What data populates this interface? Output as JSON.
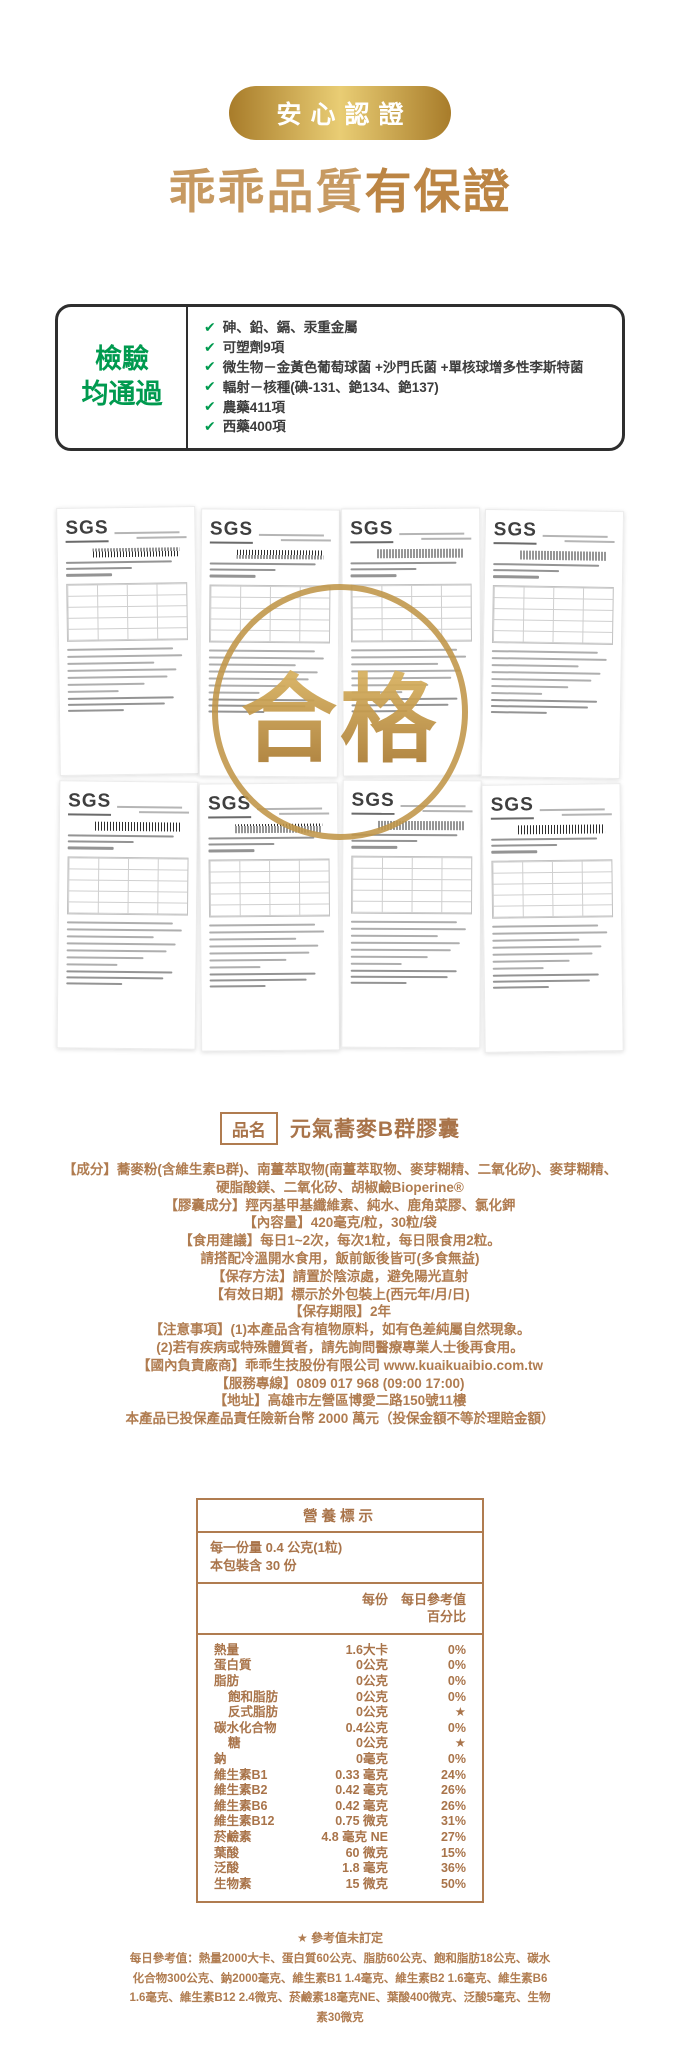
{
  "page": {
    "badge": "安心認證",
    "title_regular": "乖乖品質",
    "title_bold": "有保證",
    "colors": {
      "gold": "#c79a62",
      "green": "#009a4f",
      "tan": "#a9744a"
    }
  },
  "inspection": {
    "label_line1": "檢驗",
    "label_line2": "均通過",
    "check_icon": "✔",
    "items": [
      "砷、鉛、鎘、汞重金屬",
      "可塑劑9項",
      "微生物－金黃色葡萄球菌 +沙門氏菌 +單核球增多性李斯特菌",
      "輻射－核種(碘-131、銫134、銫137)",
      "農藥411項",
      "西藥400項"
    ]
  },
  "certificates": {
    "logo": "SGS",
    "count": 8,
    "stamp_text": "合格"
  },
  "product": {
    "name_label": "品名",
    "name": "元氣蕎麥B群膠囊",
    "details": [
      "【成分】蕎麥粉(含維生素B群)、南薑萃取物(南薑萃取物、麥芽糊精、二氧化矽)、麥芽糊精、",
      "硬脂酸鎂、二氧化矽、胡椒鹼Bioperine®",
      "【膠囊成分】羥丙基甲基纖維素、純水、鹿角菜膠、氯化鉀",
      "【內容量】420毫克/粒，30粒/袋",
      "【食用建議】每日1~2次，每次1粒，每日限食用2粒。",
      "請搭配冷溫開水食用，飯前飯後皆可(多食無益)",
      "【保存方法】請置於陰涼處，避免陽光直射",
      "【有效日期】標示於外包裝上(西元年/月/日)",
      "【保存期限】2年",
      "【注意事項】(1)本產品含有植物原料，如有色差純屬自然現象。",
      "(2)若有疾病或特殊體質者，請先詢問醫療專業人士後再食用。",
      "【國內負責廠商】乖乖生技股份有限公司 www.kuaikuaibio.com.tw",
      "【服務專線】0809 017 968 (09:00 17:00)",
      "【地址】高雄市左營區博愛二路150號11樓",
      "本產品已投保產品責任險新台幣 2000 萬元（投保金額不等於理賠金額）"
    ]
  },
  "nutrition": {
    "title": "營養標示",
    "serving_size": "每一份量 0.4 公克(1粒)",
    "servings_per_pack": "本包裝含 30 份",
    "col_per_serving": "每份",
    "col_daily_value_line1": "每日參考值",
    "col_daily_value_line2": "百分比",
    "rows": [
      {
        "name": "熱量",
        "amount": "1.6大卡",
        "dv": "0%",
        "indent": false
      },
      {
        "name": "蛋白質",
        "amount": "0公克",
        "dv": "0%",
        "indent": false
      },
      {
        "name": "脂肪",
        "amount": "0公克",
        "dv": "0%",
        "indent": false
      },
      {
        "name": "飽和脂肪",
        "amount": "0公克",
        "dv": "0%",
        "indent": true
      },
      {
        "name": "反式脂肪",
        "amount": "0公克",
        "dv": "★",
        "indent": true
      },
      {
        "name": "碳水化合物",
        "amount": "0.4公克",
        "dv": "0%",
        "indent": false
      },
      {
        "name": "糖",
        "amount": "0公克",
        "dv": "★",
        "indent": true
      },
      {
        "name": "鈉",
        "amount": "0毫克",
        "dv": "0%",
        "indent": false
      },
      {
        "name": "維生素B1",
        "amount": "0.33 毫克",
        "dv": "24%",
        "indent": false
      },
      {
        "name": "維生素B2",
        "amount": "0.42 毫克",
        "dv": "26%",
        "indent": false
      },
      {
        "name": "維生素B6",
        "amount": "0.42 毫克",
        "dv": "26%",
        "indent": false
      },
      {
        "name": "維生素B12",
        "amount": "0.75 微克",
        "dv": "31%",
        "indent": false
      },
      {
        "name": "菸鹼素",
        "amount": "4.8 毫克 NE",
        "dv": "27%",
        "indent": false
      },
      {
        "name": "葉酸",
        "amount": "60 微克",
        "dv": "15%",
        "indent": false
      },
      {
        "name": "泛酸",
        "amount": "1.8 毫克",
        "dv": "36%",
        "indent": false
      },
      {
        "name": "生物素",
        "amount": "15 微克",
        "dv": "50%",
        "indent": false
      }
    ],
    "footnote_star": "★ 參考值未訂定",
    "footnote": "每日參考值：熱量2000大卡、蛋白質60公克、脂肪60公克、飽和脂肪18公克、碳水化合物300公克、鈉2000毫克、維生素B1 1.4毫克、維生素B2 1.6毫克、維生素B6 1.6毫克、維生素B12 2.4微克、菸鹼素18毫克NE、葉酸400微克、泛酸5毫克、生物素30微克"
  }
}
